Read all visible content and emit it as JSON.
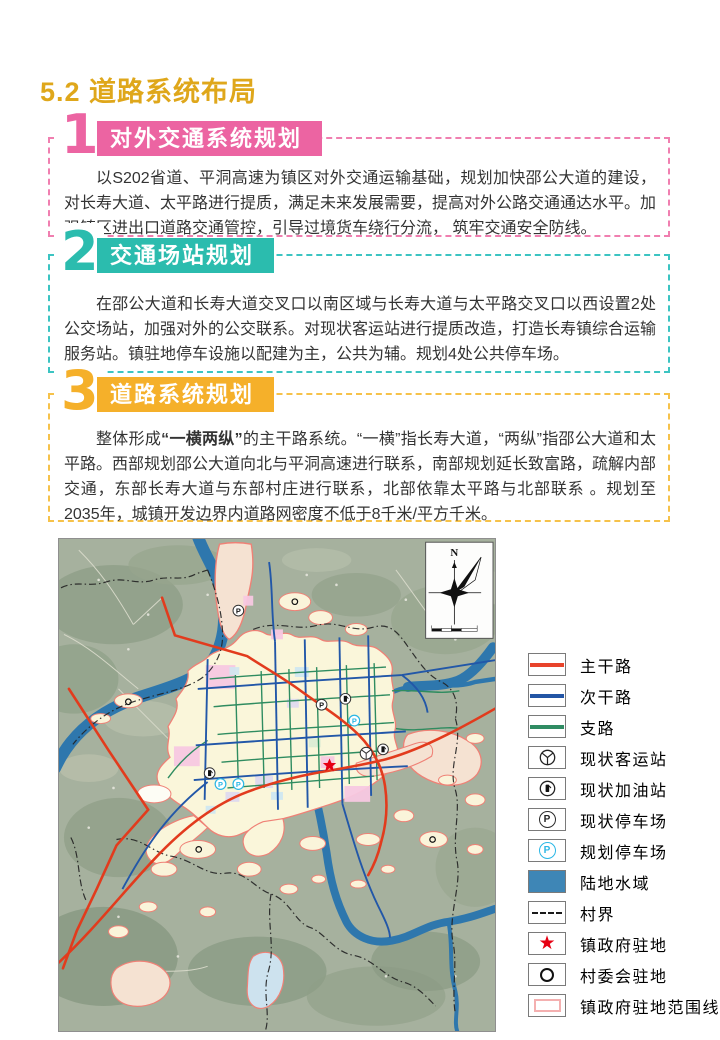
{
  "page": {
    "title": "5.2 道路系统布局"
  },
  "sections": [
    {
      "number": "1",
      "heading": "对外交通系统规划",
      "body": "以S202省道、平洞高速为镇区对外交通运输基础，规划加快邵公大道的建设，对长寿大道、太平路进行提质，满足未来发展需要，提高对外公路交通通达水平。加强镇区进出口道路交通管控，引导过境货车绕行分流， 筑牢交通安全防线。",
      "color": "#ec64a2"
    },
    {
      "number": "2",
      "heading": "交通场站规划",
      "body": "在邵公大道和长寿大道交叉口以南区域与长寿大道与太平路交叉口以西设置2处公交场站，加强对外的公交联系。对现状客运站进行提质改造，打造长寿镇综合运输服务站。镇驻地停车设施以配建为主，公共为辅。规划4处公共停车场。",
      "color": "#2bbcae"
    },
    {
      "number": "3",
      "heading": "道路系统规划",
      "body_parts": {
        "p1": "整体形成",
        "p2": "“一横两纵”",
        "p3": "的主干路系统。“一横”指长寿大道，“两纵”指邵公大道和太平路。西部规划邵公大道向北与平洞高速进行联系，南部规划延长致富路，疏解内部交通，东部长寿大道与东部村庄进行联系，北部依靠太平路与北部联系 。规划至2035年，城镇开发边界内道路网密度不低于8千米/平方千米。"
      },
      "color": "#f5b02a"
    }
  ],
  "map": {
    "compass_label": "N"
  },
  "icons": {
    "parking_letter": "P",
    "star": "★",
    "compass": "N"
  },
  "legend": {
    "items": [
      {
        "label": "主干路",
        "type": "line",
        "color": "#e8432b"
      },
      {
        "label": "次干路",
        "type": "line",
        "color": "#2255a5"
      },
      {
        "label": "支路",
        "type": "line",
        "color": "#2f8c63"
      },
      {
        "label": "现状客运站",
        "type": "bus-station-icon"
      },
      {
        "label": "现状加油站",
        "type": "gas-station-icon"
      },
      {
        "label": "现状停车场",
        "type": "parking-existing",
        "color": "#2c2c2c"
      },
      {
        "label": "规划停车场",
        "type": "parking-planned",
        "color": "#2bb7e5"
      },
      {
        "label": "陆地水域",
        "type": "water-fill",
        "color": "#3e86b6"
      },
      {
        "label": "村界",
        "type": "dash-line"
      },
      {
        "label": "镇政府驻地",
        "type": "star",
        "color": "#e60012"
      },
      {
        "label": "村委会驻地",
        "type": "ring"
      },
      {
        "label": "镇政府驻地范围线",
        "type": "range-box",
        "color": "#f4b0b0"
      }
    ]
  }
}
